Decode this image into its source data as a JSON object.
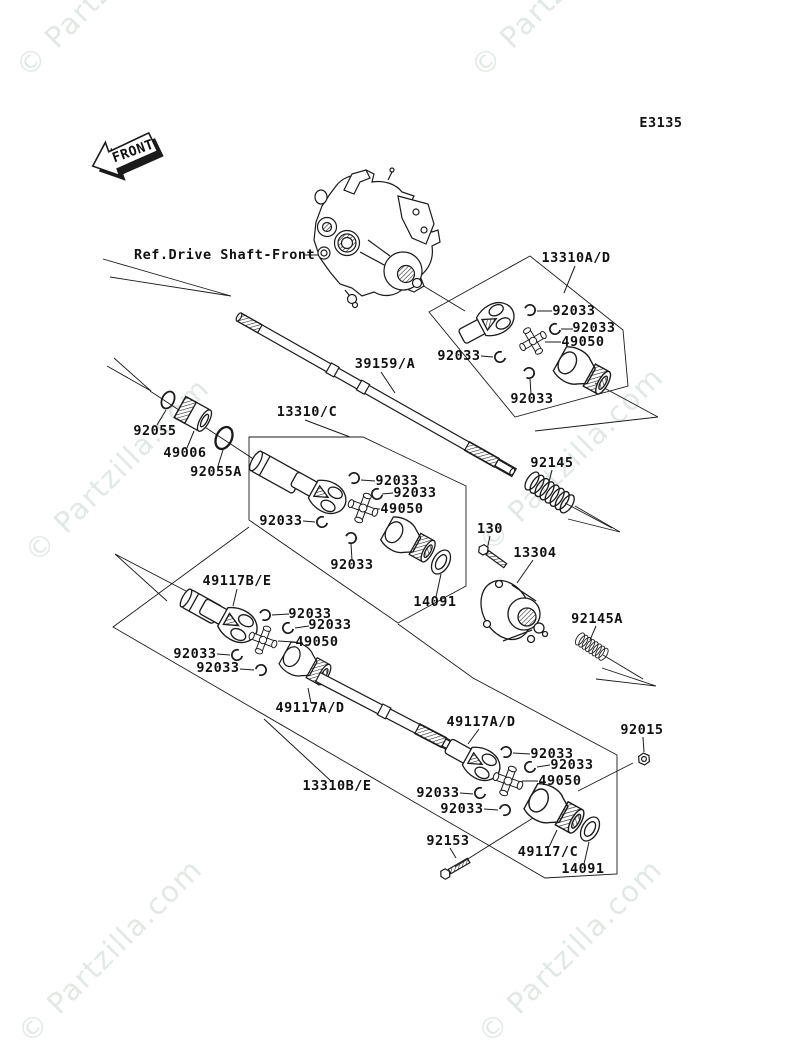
{
  "header": {
    "diagram_code": "E3135",
    "front_marker": "FRONT",
    "reference_label": "Ref.Drive Shaft-Front"
  },
  "watermark": {
    "text": "© Partzilla.com",
    "color": "#e2e9e4"
  },
  "diagram": {
    "line_color": "#1a1a1a",
    "background": "#ffffff",
    "type": "exploded-parts-diagram",
    "subject": "Drive Shaft / Propeller Shaft"
  },
  "part_labels": [
    {
      "text": "13310A/D"
    },
    {
      "text": "92033"
    },
    {
      "text": "92033"
    },
    {
      "text": "49050"
    },
    {
      "text": "92033"
    },
    {
      "text": "92033"
    },
    {
      "text": "39159/A"
    },
    {
      "text": "13310/C"
    },
    {
      "text": "92055"
    },
    {
      "text": "49006"
    },
    {
      "text": "92055A"
    },
    {
      "text": "92145"
    },
    {
      "text": "92033"
    },
    {
      "text": "92033"
    },
    {
      "text": "49050"
    },
    {
      "text": "92033"
    },
    {
      "text": "130"
    },
    {
      "text": "13304"
    },
    {
      "text": "92033"
    },
    {
      "text": "14091"
    },
    {
      "text": "92145A"
    },
    {
      "text": "49117B/E"
    },
    {
      "text": "92033"
    },
    {
      "text": "92033"
    },
    {
      "text": "49050"
    },
    {
      "text": "92033"
    },
    {
      "text": "92033"
    },
    {
      "text": "49117A/D"
    },
    {
      "text": "49117A/D"
    },
    {
      "text": "13310B/E"
    },
    {
      "text": "92015"
    },
    {
      "text": "92033"
    },
    {
      "text": "92033"
    },
    {
      "text": "49050"
    },
    {
      "text": "92033"
    },
    {
      "text": "92033"
    },
    {
      "text": "92153"
    },
    {
      "text": "49117/C"
    },
    {
      "text": "14091"
    }
  ]
}
